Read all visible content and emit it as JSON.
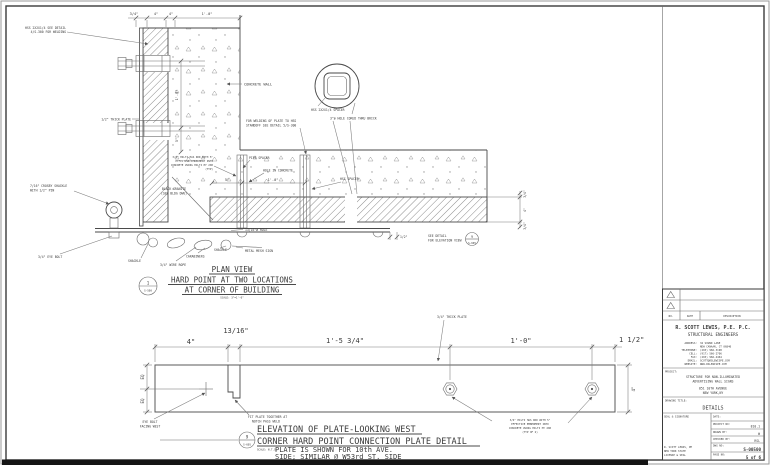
{
  "plan": {
    "title1": "PLAN VIEW",
    "title2": "HARD POINT AT TWO LOCATIONS",
    "title3": "AT CORNER OF BUILDING",
    "scale": "SCALE: 3\"=1'-0\"",
    "bubble_num": "1",
    "bubble_sheet": "S-500",
    "dims": {
      "top1": "3/4\"",
      "top2": "4\"",
      "top3": "4\"",
      "top4": "1'-0\"",
      "v1": "1'-0\"",
      "v2": "5\"",
      "b1": "5\"",
      "b2": "1'-0\"",
      "r1": "3/4\"",
      "r2": "4\"",
      "r3": "3/4\"",
      "half": "1/2\""
    },
    "labels": {
      "hss1": "HSS 2X2X1/4 SEE DETAIL",
      "hss2": "4/S-300 FOR WELDING",
      "plate": "1/2\" THICK PLATE",
      "concrete": "CONCRETE WALL",
      "weld1": "FOR WELDING OF PLATE TO HSS",
      "weld2": "STANDOFF SEE DETAIL 5/S-300",
      "spacer": "HSS 2X2X1/4 SPACER",
      "cored": "3\"ø HOLE CORED THRU BRICK",
      "hilti1": "3/4\" HILTI HAS ROD WITH 5\"",
      "hilti2": "EFFECTIVE EMBEDMENT INTO",
      "hilti3": "CONCRETE USING HILTI HY 200",
      "hilti4": "(TYP)",
      "pipe": "PIPE SPACER",
      "hole": "HOLE IN CONCRETE",
      "hss_sp": "HSS SPACER",
      "granite1": "BLACK GRANITE",
      "granite2": "(SEE BLDG DWG)",
      "crosby1": "7/16\" CROSBY SHACKLE",
      "crosby2": "WITH 1/2\" PIN",
      "eye": "3/4\" EYE BOLT",
      "shackle": "SHACKLE",
      "rope": "3/4\" WIRE ROPE",
      "carab": "CARABINERS",
      "shackle2": "SHACKLE",
      "mesh": "METAL MESH SIGN",
      "hole2": "13/16\"ø HOLE",
      "see1": "SEE DETAIL",
      "see2": "FOR ELEVATION VIEW",
      "see_num": "9",
      "see_sheet": "S-605"
    }
  },
  "elev": {
    "title1": "ELEVATION OF PLATE-LOOKING WEST",
    "title2": "CORNER HARD POINT CONNECTION PLATE DETAIL",
    "title3": "PLATE IS SHOWN FOR 10th AVE.",
    "title4": "SIDE; SIMILAR @ W53rd ST. SIDE",
    "scale": "SCALE: N.T.S.",
    "bubble_num": "9",
    "bubble_sheet": "S-605",
    "dims": {
      "d1": "4\"",
      "d2": "13/16\"",
      "d3": "1'-5 3/4\"",
      "d4": "1'-0\"",
      "d5": "1 1/2\"",
      "eq1": "EQ",
      "eq2": "EQ",
      "right": "4\""
    },
    "labels": {
      "thick": "3/4\" THICK PLATE",
      "eye1": "EYE BOLT",
      "eye2": "FACING WEST",
      "notch1": "FIT PLATE TOGETHER AT",
      "notch2": "NOTCH PASS WELD",
      "hilti1": "3/4\" HILTI HAS ROD WITH 5\"",
      "hilti2": "EFFECTIVE EMBEDMENT INTO",
      "hilti3": "CONCRETE USING HILTI HY 200",
      "hilti4": "(TYP OF 2)"
    }
  },
  "tb": {
    "no": "NO.",
    "date": "DATE",
    "desc": "DESCRIPTION",
    "firm": "R. SCOTT LEWIS, P.E. P.C.",
    "firm2": "STRUCTURAL ENGINEERS",
    "rows": [
      {
        "k": "ADDRESS:",
        "v": "34 SOUND LANE"
      },
      {
        "k": "",
        "v": "NEW CANAAN, CT 06840"
      },
      {
        "k": "TELEPHONE:",
        "v": "(203) 966-3198"
      },
      {
        "k": "CELL:",
        "v": "(917) 566-2706"
      },
      {
        "k": "FAX:",
        "v": "(203) 966-4464"
      },
      {
        "k": "EMAIL:",
        "v": "SCOTT@RSLEWISPE.COM"
      },
      {
        "k": "WEBSITE:",
        "v": "WWW.RSLEWISPE.COM"
      }
    ],
    "project_label": "PROJECT:",
    "p1": "STRUCTURE FOR NON-ILLUMINATED",
    "p2": "ADVERTISING WALL SIGNS",
    "p3": "851 10TH AVENUE",
    "p4": "NEW YORK,NY",
    "dt_label": "DRAWING TITLE:",
    "dt": "DETAILS",
    "seal": "SEAL & SIGNATURE",
    "date_label": "DATE:",
    "proj_no_label": "PROJECT NO:",
    "proj_no": "810.1",
    "drawn_label": "DRAWN BY:",
    "drawn": "W",
    "checked_label": "CHECKED BY:",
    "checked": "RSL",
    "dwg_label": "DWG NO:",
    "dwg": "S-00500",
    "page_label": "PAGE NO:",
    "page": "5 of 6",
    "lic1": "R. SCOTT LEWIS, PE",
    "lic2": "NEW YORK STATE",
    "lic3": "LICENSE & SEAL"
  }
}
